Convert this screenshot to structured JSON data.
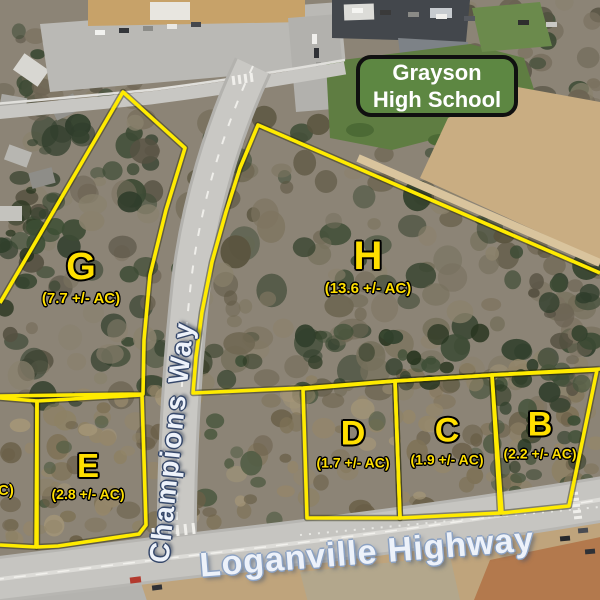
{
  "school_sign": {
    "label": "Grayson High School"
  },
  "road_labels": {
    "champions_way": "Champions Way",
    "loganville_highway": "Loganville Highway"
  },
  "parcels": [
    {
      "id": "G",
      "acreage": "(7.7 +/- AC)"
    },
    {
      "id": "H",
      "acreage": "(13.6 +/- AC)"
    },
    {
      "id": "E",
      "acreage": "(2.8 +/- AC)"
    },
    {
      "id": "D",
      "acreage": "(1.7 +/- AC)"
    },
    {
      "id": "C",
      "acreage": "(1.9 +/- AC)"
    },
    {
      "id": "B",
      "acreage": "(2.2 +/- AC)"
    }
  ],
  "partial_label": "C)",
  "colors": {
    "parcel_outline": "#ffeb00",
    "parcel_text": "#ffdf00",
    "sign_bg": "#5d8742",
    "sign_text": "#ffffff",
    "road_label_fill": "#edf2fa"
  }
}
